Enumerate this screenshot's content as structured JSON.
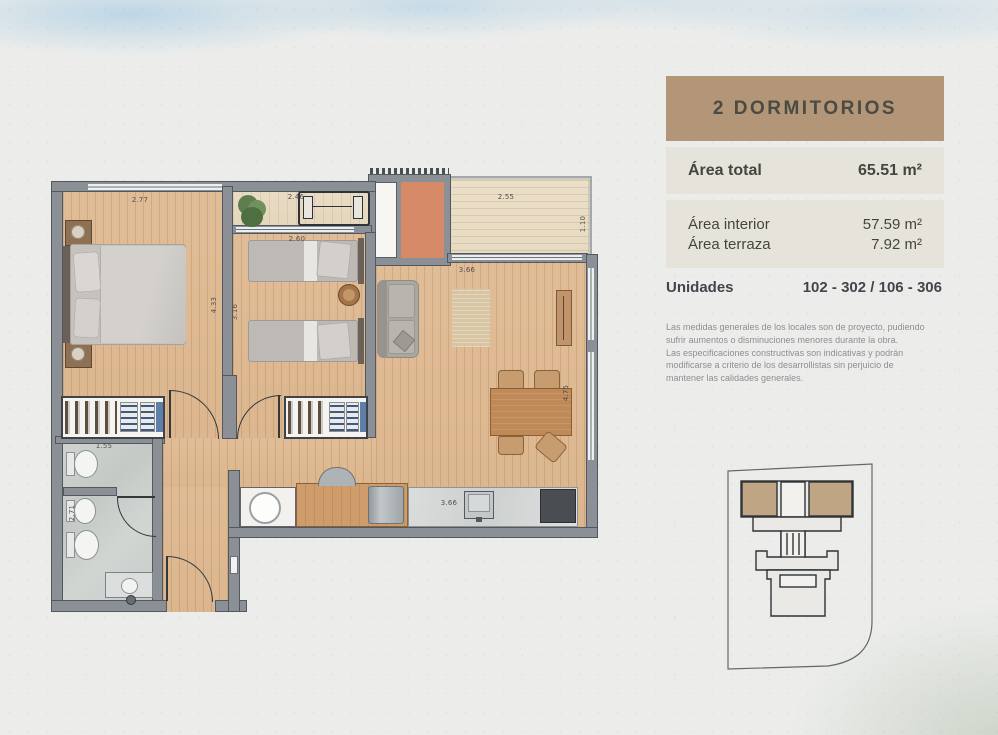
{
  "panel": {
    "title": "2 DORMITORIOS",
    "area_total": {
      "label": "Área total",
      "value": "65.51 m²"
    },
    "area_interior": {
      "label": "Área interior",
      "value": "57.59 m²"
    },
    "area_terraza": {
      "label": "Área terraza",
      "value": "7.92 m²"
    },
    "unidades": {
      "label": "Unidades",
      "value": "102 - 302 / 106 - 306"
    },
    "disclaimer": "Las medidas generales de los locales son de proyecto, pudiendo\nsufrir aumentos o disminuciones menores durante la obra.\nLas especificaciones constructivas son indicativas y podrán\nmodificarse a criterio de los desarrollistas sin perjuicio de\nmantener las calidades generales."
  },
  "plan": {
    "dims": [
      {
        "id": "bedroom1-width",
        "v": "2.77"
      },
      {
        "id": "balcony-width",
        "v": "2.46"
      },
      {
        "id": "terrace-width",
        "v": "2.55"
      },
      {
        "id": "terrace-depth",
        "v": "1.10"
      },
      {
        "id": "bedroom2-width",
        "v": "2.60"
      },
      {
        "id": "living-width",
        "v": "3.66"
      },
      {
        "id": "bedroom1-length",
        "v": "4.33"
      },
      {
        "id": "bedroom2-length",
        "v": "3.16"
      },
      {
        "id": "living-length",
        "v": "4.75"
      },
      {
        "id": "bathroom-width",
        "v": "1.55"
      },
      {
        "id": "bathroom-length",
        "v": "2.71"
      },
      {
        "id": "kitchen-counter",
        "v": "3.66"
      }
    ]
  },
  "colors": {
    "accent_tan": "#b29677",
    "panel_gray": "#e6e3db",
    "wall_gray": "#8a9096",
    "wood_floor": "#dfbb95",
    "terrace_wood": "#e9dec8",
    "terracotta_tile": "#d78a68",
    "bath_marble": "#c9cecb",
    "keyplan_highlight": "#c0a585",
    "watercolor_blue": "#bcd8ea",
    "watercolor_green": "#c6d2c4"
  }
}
